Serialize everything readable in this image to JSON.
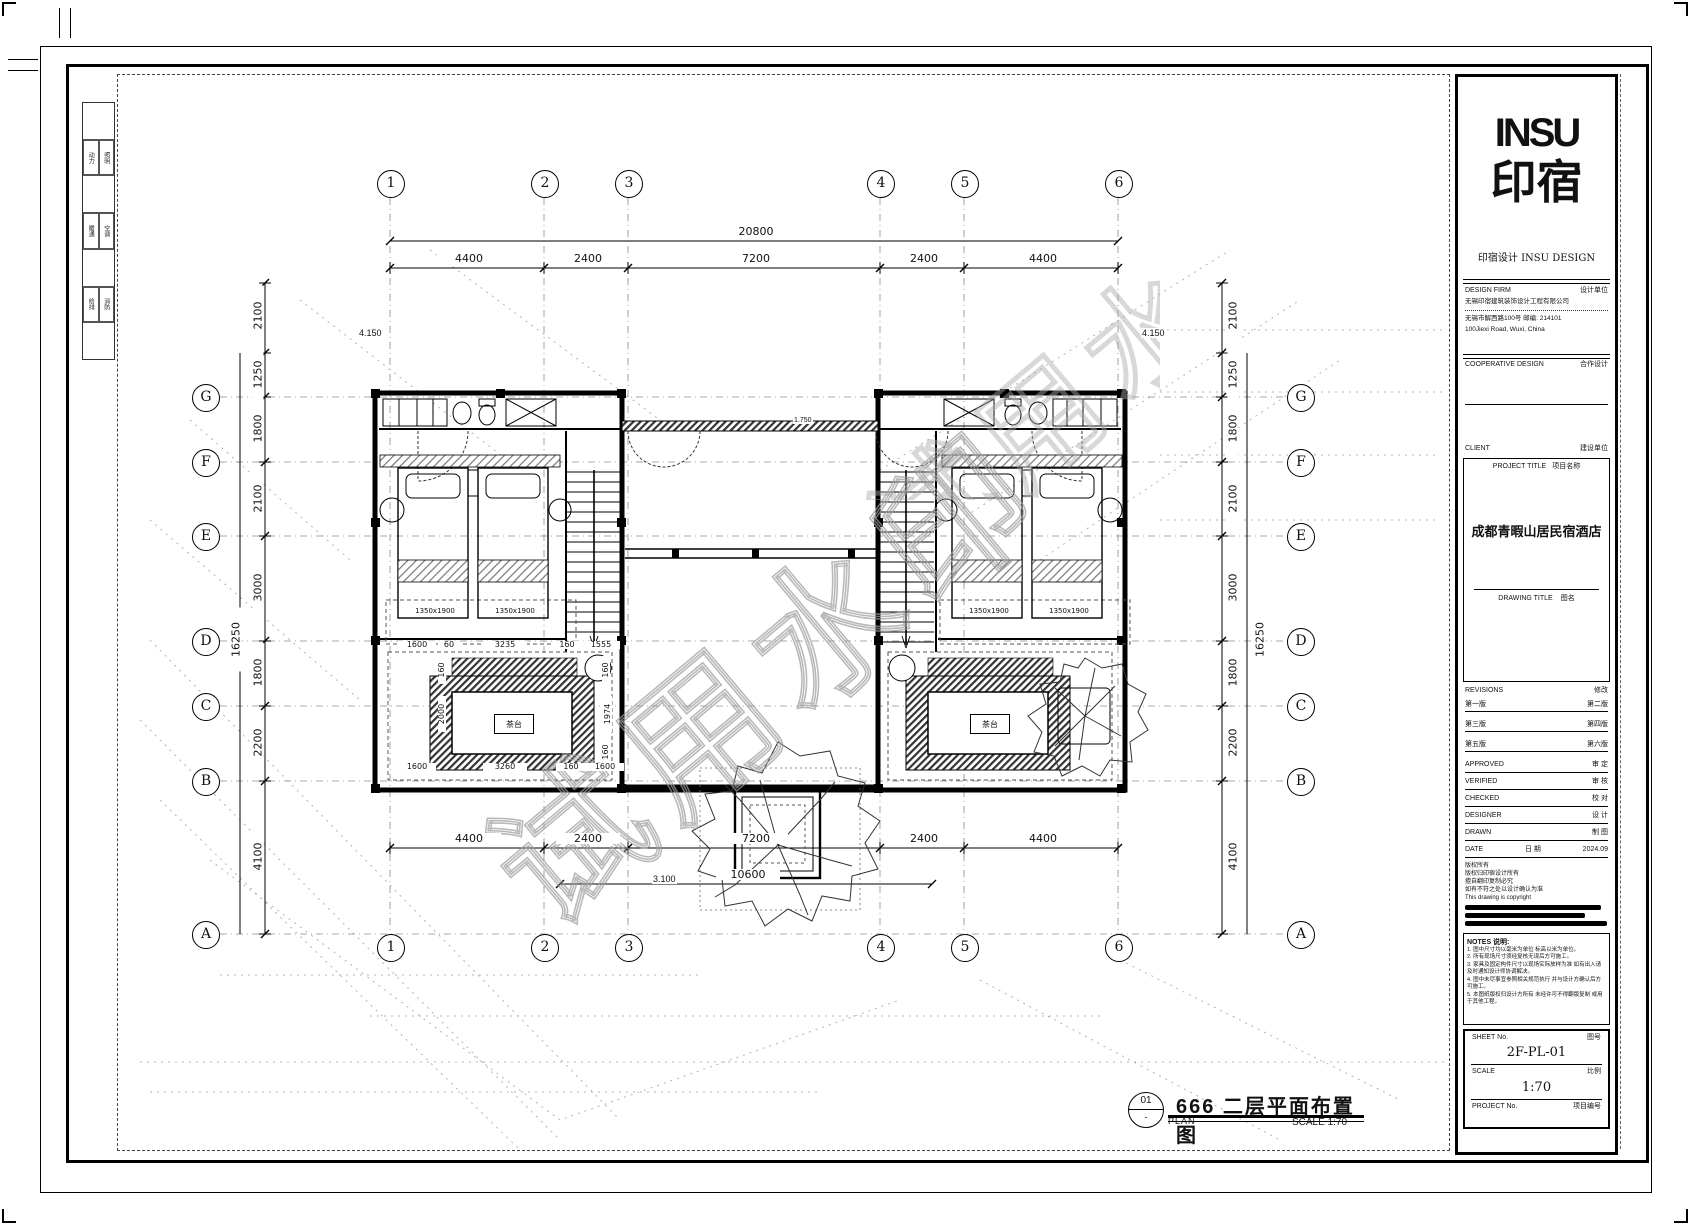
{
  "watermark": "试用水印",
  "legend": {
    "pairs": [
      [
        "动力",
        "照明"
      ],
      [
        "暖通",
        "空调"
      ],
      [
        "给排",
        "消防"
      ]
    ]
  },
  "grid": {
    "cols": [
      "1",
      "2",
      "3",
      "4",
      "5",
      "6"
    ],
    "rows": [
      "G",
      "F",
      "E",
      "D",
      "C",
      "B",
      "A"
    ]
  },
  "dims": {
    "top_total": "20800",
    "top_segments": [
      "4400",
      "2400",
      "7200",
      "2400",
      "4400"
    ],
    "bottom_segments": [
      "4400",
      "2400",
      "7200",
      "2400",
      "4400"
    ],
    "bottom_total": "10600",
    "left_total": "16250",
    "right_total": "16250",
    "left_segments": [
      "2100",
      "1250",
      "1800",
      "2100",
      "3000",
      "1800",
      "2200",
      "4100"
    ],
    "right_segments": [
      "2100",
      "1250",
      "1800",
      "2100",
      "3000",
      "1800",
      "2200",
      "4100"
    ],
    "lounge_top": [
      "1600",
      "60",
      "3235",
      "160",
      "1555"
    ],
    "lounge_left": [
      "160",
      "2000"
    ],
    "lounge_right": [
      "160",
      "1974",
      "160"
    ],
    "lounge_bottom": [
      "1600",
      "3260",
      "160",
      "1600"
    ],
    "bed_size": "1350x1900"
  },
  "levels": {
    "upper_left": "4.150",
    "upper_right": "4.150",
    "wall": "1.750",
    "courtyard": "3.100"
  },
  "room_labels": {
    "tea_table": "茶台"
  },
  "footer": {
    "number": "01",
    "plan": "PLAN",
    "title": "666 二层平面布置图",
    "scale": "SCALE 1:70"
  },
  "title_block": {
    "logo_top": "INSU",
    "logo_cn": "印宿",
    "brand_line": "印宿设计 INSU DESIGN",
    "design_firm_en": "DESIGN FIRM",
    "design_firm_cn": "设计单位",
    "firm_name": "无锡印宿建筑装饰设计工程有限公司",
    "address_cn": "无锡市解西路100号 邮编: 214101",
    "address_en": "100Jiexi Road, Wuxi, China",
    "coop_en": "COOPERATIVE DESIGN",
    "coop_cn": "合作设计",
    "client_en": "CLIENT",
    "client_cn": "建设单位",
    "project_title_en": "PROJECT TITLE",
    "project_title_cn": "项目名称",
    "project_name": "成都青暇山居民宿酒店",
    "drawing_title_en": "DRAWING TITLE",
    "drawing_title_cn": "图名",
    "revisions_en": "REVISIONS",
    "revisions_cn": "修改",
    "revision_rows": [
      [
        "第一版",
        "第二版"
      ],
      [
        "第三版",
        "第四版"
      ],
      [
        "第五版",
        "第六版"
      ]
    ],
    "sign_rows": [
      [
        "APPROVED",
        "审 定"
      ],
      [
        "VERIFIED",
        "审 核"
      ],
      [
        "CHECKED",
        "校 对"
      ],
      [
        "DESIGNER",
        "设 计"
      ],
      [
        "DRAWN",
        "制 图"
      ]
    ],
    "date_en": "DATE",
    "date_cn": "日 期",
    "date_value": "2024.09",
    "copyright_cn": [
      "版权所有",
      "版权归印宿设计所有",
      "擅自翻印复制必究",
      "如有不符之处以设计确认为准"
    ],
    "copyright_en": "This drawing is copyright",
    "notes_title": "NOTES 说明:",
    "notes": [
      "1. 图中尺寸均以毫米为单位 标高以米为单位。",
      "2. 所有现场尺寸须经复核无误后方可施工。",
      "3. 家具及固定构件尺寸以现场实际放样为准 如有出入请及时通知设计师协调解决。",
      "4. 图中未尽事宜参照相关规范执行 并与设计方确认后方可施工。",
      "5. 本图纸版权归设计方所有 未经许可不得翻版复制 或用于其他工程。"
    ],
    "sheet_en": "SHEET No.",
    "sheet_cn": "图号",
    "sheet_value": "2F-PL-01",
    "scale_en": "SCALE",
    "scale_cn": "比例",
    "scale_value": "1:70",
    "project_no_en": "PROJECT No.",
    "project_no_cn": "项目编号"
  }
}
